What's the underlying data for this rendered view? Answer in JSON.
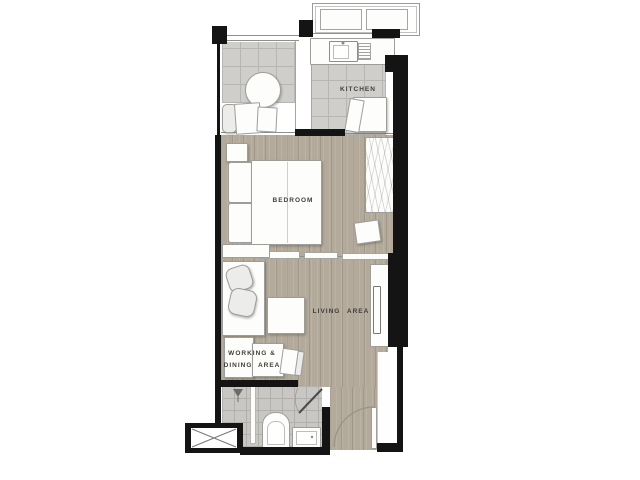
{
  "plan": {
    "type": "floor-plan",
    "description": "one-bedroom condominium unit floor plan",
    "labels": {
      "kitchen": "KITCHEN",
      "bedroom": "BEDROOM",
      "living": "LIVING AREA",
      "working_line1": "WORKING &",
      "working_line2": "DINING AREA"
    },
    "colors": {
      "wall": "#141414",
      "wood_floor": "#b3aa9b",
      "wood_grain": "#a2988a",
      "tile_floor": "#cfcecb",
      "tile_line": "#b7b6b2",
      "bath_tile": "#c8c7c4",
      "furniture_fill": "#fdfdfc",
      "furniture_line": "#9d9d9a",
      "label_text": "#413e39",
      "background": "#ffffff"
    },
    "fixtures": [
      "ac-ledge",
      "ac-unit",
      "balcony-table",
      "lounge-chair",
      "kitchen-counter",
      "kitchen-sink",
      "drainboard",
      "fridge",
      "bed",
      "pillows",
      "nightstand",
      "wardrobe",
      "foot-bench",
      "side-table",
      "sofa",
      "cushions",
      "coffee-table",
      "tv-console",
      "tv",
      "work-table",
      "chair",
      "shower-head",
      "shower-screen",
      "toilet",
      "washbasin",
      "condenser-unit",
      "entry-door",
      "bathroom-door"
    ]
  }
}
